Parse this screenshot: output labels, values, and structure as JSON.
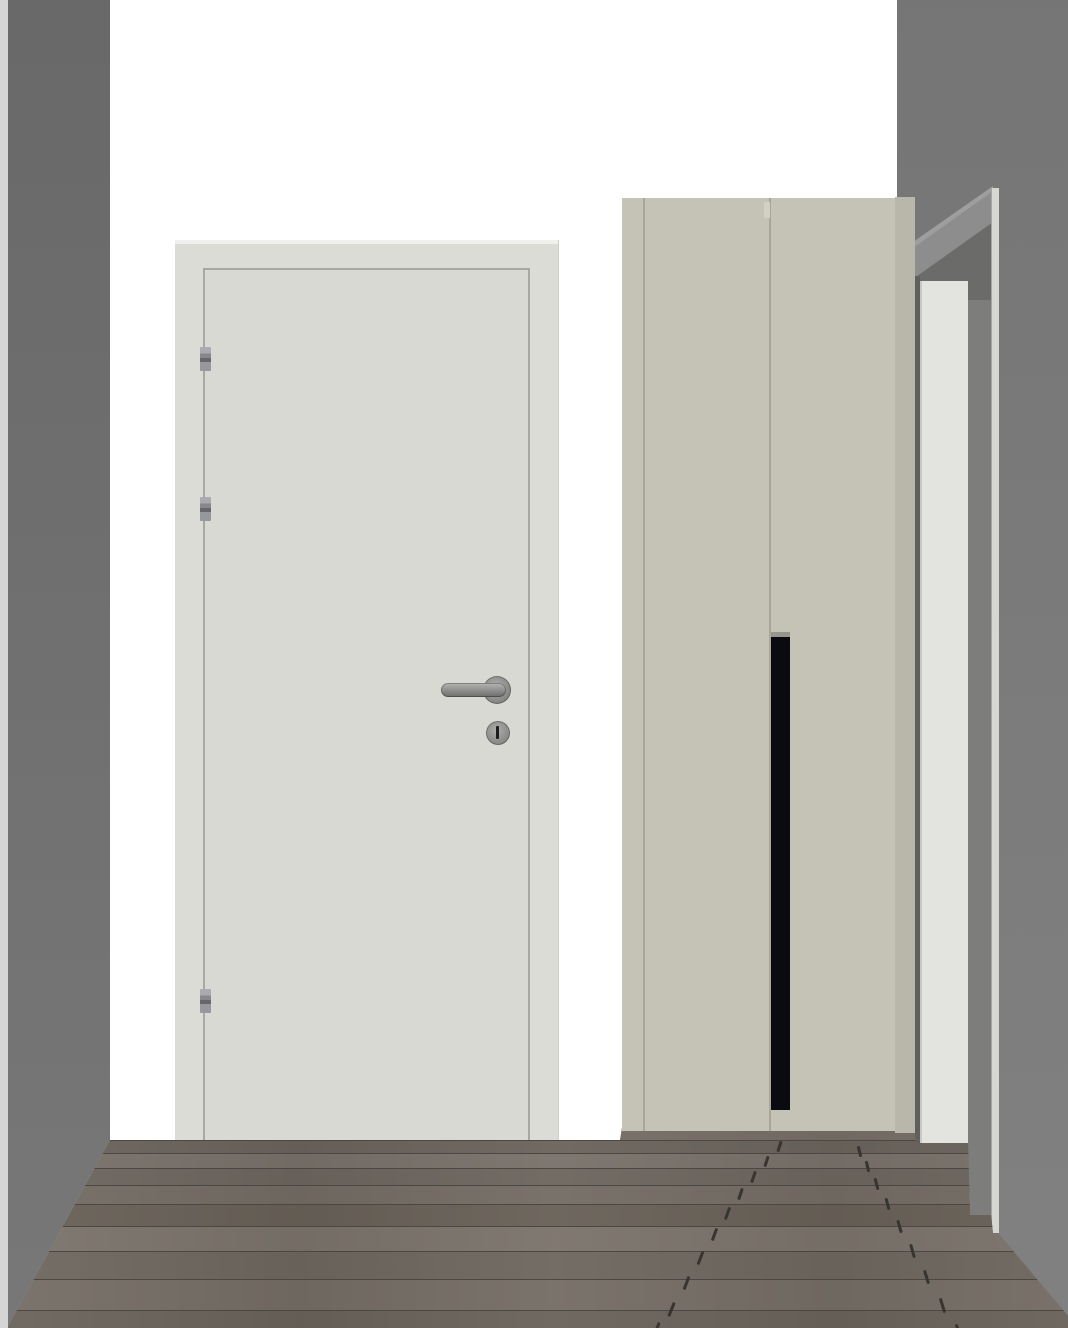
{
  "scene": {
    "type": "3d-interior-render",
    "description": "Hallway view with white interior door, two-door wardrobe, side doorway and wood plank floor",
    "width": 1068,
    "height": 1328
  },
  "palette": {
    "back_wall": "#ffffff",
    "left_wall": "#6c6c6c",
    "left_wall_edge": "#d5d5d5",
    "right_wall": "#7a7a7a",
    "door_frame": "#dcdcd7",
    "door_frame_highlight": "#f0f0ed",
    "door_leaf": "#d9d9d4",
    "door_leaf_outline": "#a7a7a3",
    "hinge_metal": "#8e8e96",
    "handle_metal": "#8f8f8d",
    "keyhole_slot": "#1c1c1c",
    "wardrobe_front": "#c5c3b5",
    "wardrobe_side": "#b9b7a9",
    "wardrobe_seam": "#a8a69a",
    "wardrobe_notch": "#d2d0c4",
    "wardrobe_handle": "#0a0a11",
    "wardrobe_handle_cap": "#96968c",
    "doorway_gap": "#5f5f5d",
    "doorway_door": "#e3e3df",
    "doorway_jamb": "#7d7d7b",
    "doorway_frame": "#d6d6d2",
    "lintel_face": "#8d8d8d",
    "lintel_highlight": "#9e9e9e",
    "lintel_shadow": "#6b6b69",
    "floor_base": "#6f6860",
    "floor_seam": "#4c4741",
    "floor_joint": "#38342f",
    "plank_shades": [
      "#766e66",
      "#6b645d",
      "#79716a",
      "#6d665f",
      "#746c64",
      "#696158",
      "#7b736b",
      "#6e675f",
      "#756d65",
      "#6a635b"
    ]
  },
  "objects": {
    "left_wall": {
      "kind": "wall"
    },
    "back_wall": {
      "kind": "wall"
    },
    "right_wall": {
      "kind": "wall"
    },
    "interior_door": {
      "kind": "door",
      "hinges": 3,
      "hardware": [
        "lever handle",
        "keyhole"
      ]
    },
    "wardrobe": {
      "kind": "wardrobe",
      "doors": 2,
      "handle": "vertical black pull"
    },
    "right_doorway": {
      "kind": "doorway",
      "door": "white door"
    },
    "floor": {
      "kind": "wood plank floor",
      "rows": [
        {
          "y": 1128,
          "h": 12,
          "shade": 0
        },
        {
          "y": 1140,
          "h": 13,
          "shade": 1
        },
        {
          "y": 1153,
          "h": 15,
          "shade": 2
        },
        {
          "y": 1168,
          "h": 17,
          "shade": 3
        },
        {
          "y": 1185,
          "h": 19,
          "shade": 4
        },
        {
          "y": 1204,
          "h": 22,
          "shade": 5
        },
        {
          "y": 1226,
          "h": 25,
          "shade": 6
        },
        {
          "y": 1251,
          "h": 28,
          "shade": 7
        },
        {
          "y": 1279,
          "h": 31,
          "shade": 8
        },
        {
          "y": 1310,
          "h": 34,
          "shade": 9
        }
      ],
      "joints": [
        {
          "x": 778,
          "y": 1141,
          "r": 18,
          "h": 11
        },
        {
          "x": 765,
          "y": 1156,
          "r": 18,
          "h": 11
        },
        {
          "x": 752,
          "y": 1171,
          "r": 19,
          "h": 12
        },
        {
          "x": 739,
          "y": 1188,
          "r": 19,
          "h": 12
        },
        {
          "x": 726,
          "y": 1207,
          "r": 20,
          "h": 13
        },
        {
          "x": 713,
          "y": 1228,
          "r": 20,
          "h": 13
        },
        {
          "x": 699,
          "y": 1251,
          "r": 21,
          "h": 14
        },
        {
          "x": 685,
          "y": 1276,
          "r": 21,
          "h": 14
        },
        {
          "x": 670,
          "y": 1302,
          "r": 22,
          "h": 15
        },
        {
          "x": 655,
          "y": 1322,
          "r": 22,
          "h": 15
        },
        {
          "x": 858,
          "y": 1146,
          "r": -14,
          "h": 11
        },
        {
          "x": 866,
          "y": 1161,
          "r": -14,
          "h": 11
        },
        {
          "x": 875,
          "y": 1178,
          "r": -15,
          "h": 12
        },
        {
          "x": 886,
          "y": 1198,
          "r": -15,
          "h": 12
        },
        {
          "x": 898,
          "y": 1220,
          "r": -16,
          "h": 13
        },
        {
          "x": 911,
          "y": 1244,
          "r": -16,
          "h": 14
        },
        {
          "x": 925,
          "y": 1270,
          "r": -17,
          "h": 14
        },
        {
          "x": 941,
          "y": 1298,
          "r": -17,
          "h": 15
        },
        {
          "x": 957,
          "y": 1324,
          "r": -18,
          "h": 15
        }
      ]
    }
  }
}
